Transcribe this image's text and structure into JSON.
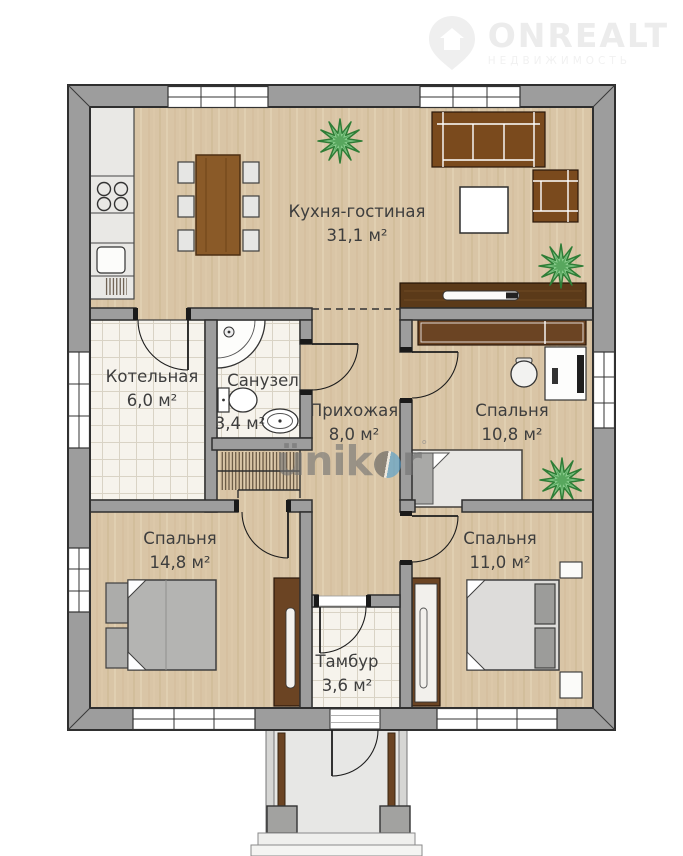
{
  "brand": {
    "name": "ONREALT",
    "tagline": "НЕДВИЖИМОСТЬ"
  },
  "watermark": {
    "part1": "ünik",
    "part2": "r",
    "reg": "°"
  },
  "rooms": [
    {
      "name": "Кухня-гостиная",
      "area": "31,1 м²"
    },
    {
      "name": "Котельная",
      "area": "6,0 м²"
    },
    {
      "name": "Санузел",
      "area": "3,4 м²"
    },
    {
      "name": "Прихожая",
      "area": "8,0 м²"
    },
    {
      "name": "Спальня",
      "area": "10,8 м²"
    },
    {
      "name": "Спальня",
      "area": "14,8 м²"
    },
    {
      "name": "Спальня",
      "area": "11,0 м²"
    },
    {
      "name": "Тамбур",
      "area": "3,6 м²"
    }
  ],
  "colors": {
    "wall": "#9d9d9d",
    "wood_floor": "#d9c5a6",
    "tile_floor": "#f6f3ec",
    "sofa_brown": "#7a4a1d",
    "cabinet_brown": "#6b4423",
    "tv_stand_brown": "#5b3a19",
    "plant_green": "#86c98a",
    "watermark_blue": "#4e9fd1",
    "label_text": "#3e3e3e"
  }
}
